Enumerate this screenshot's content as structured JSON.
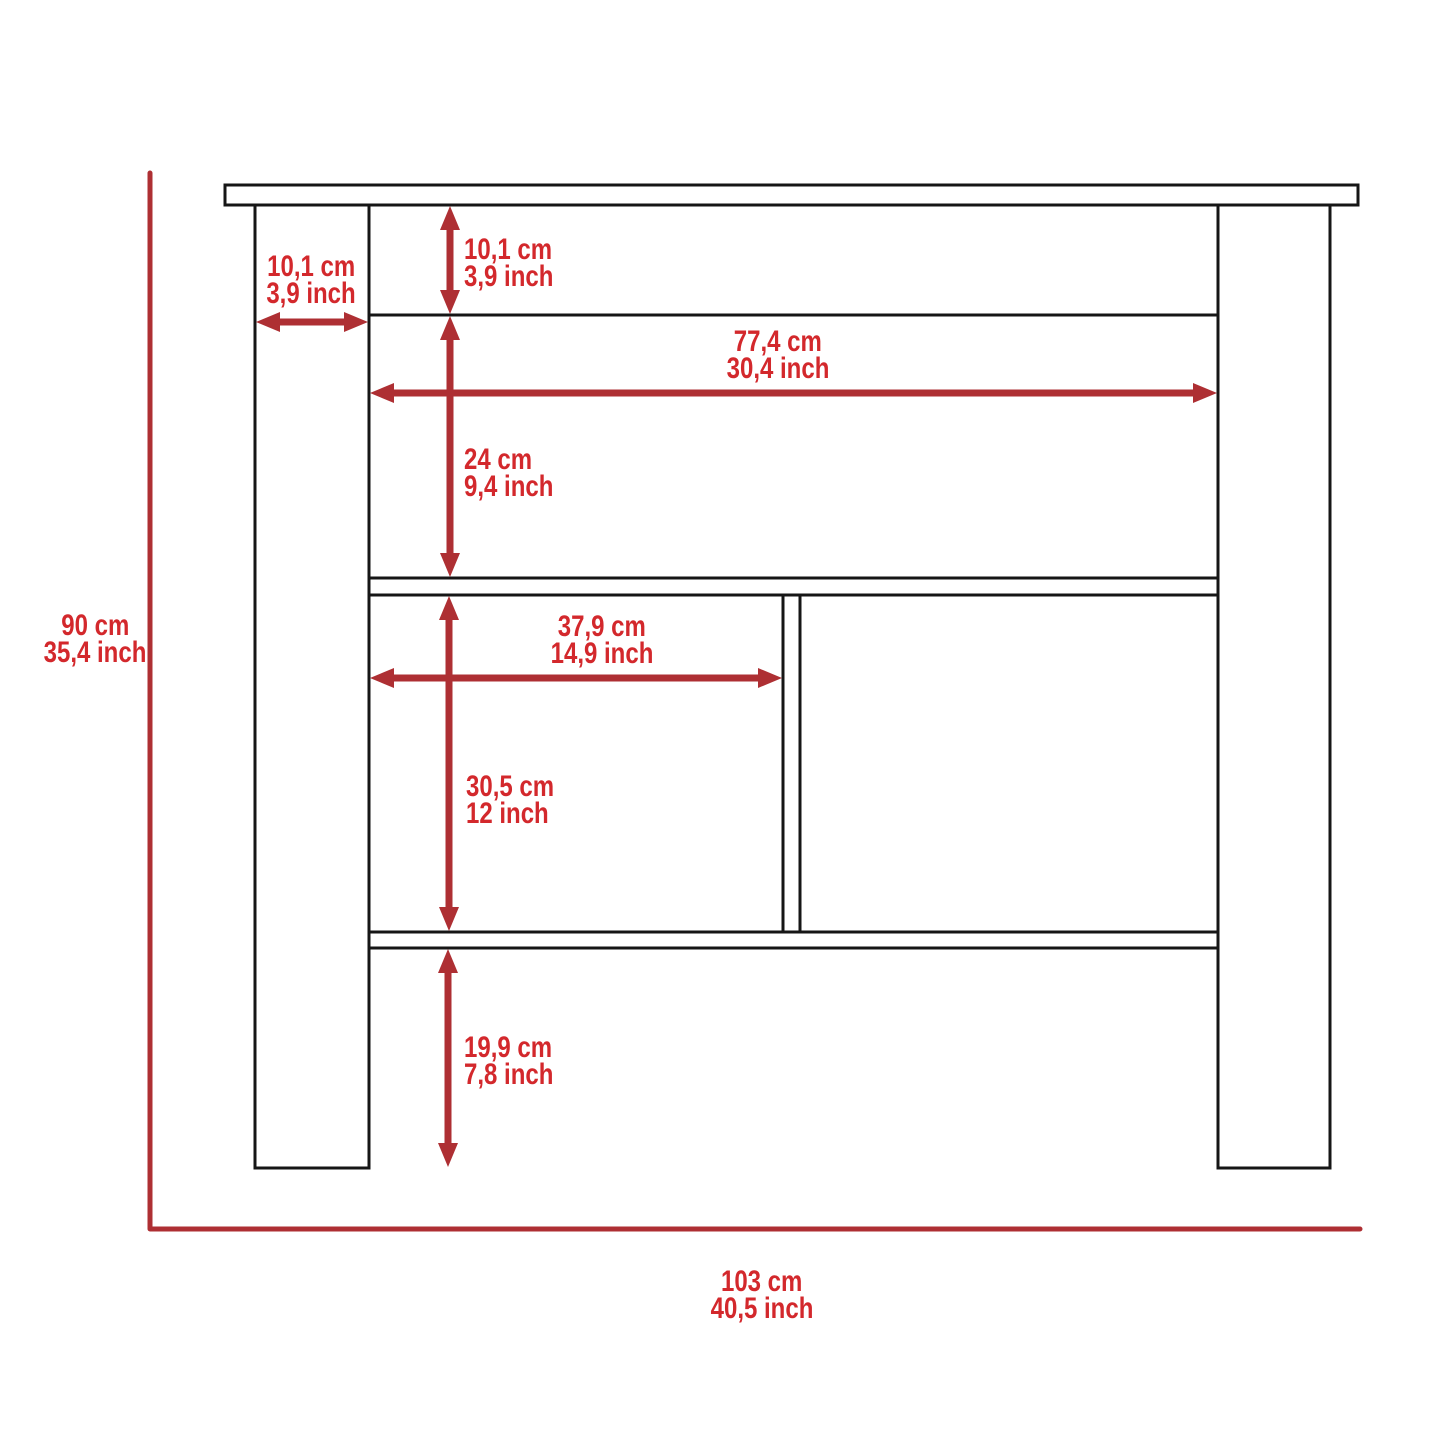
{
  "diagram": {
    "description": "kitchen-island front-view dimension drawing",
    "canvas": {
      "width": 1445,
      "height": 1445
    },
    "colors": {
      "background": "#ffffff",
      "label_red": "#d3282c",
      "line_red": "#ae2f33",
      "outline_black": "#161616"
    },
    "furniture": {
      "top_board": {
        "x": 225,
        "y": 185,
        "w": 1133,
        "h": 20
      },
      "left_leg": {
        "x": 255,
        "y": 205,
        "w": 114,
        "h": 963
      },
      "right_leg": {
        "x": 1218,
        "y": 205,
        "w": 112,
        "h": 963
      },
      "apron_bottom_line": {
        "x1": 369,
        "x2": 1218,
        "y": 315
      },
      "middle_shelf": {
        "x": 369,
        "y": 578,
        "w": 849,
        "h": 17
      },
      "bottom_shelf": {
        "x": 369,
        "y": 932,
        "w": 849,
        "h": 16
      },
      "divider": {
        "x": 783,
        "y": 595,
        "w": 17,
        "h": 337
      }
    },
    "reference_corner": {
      "x": 150,
      "top": 173,
      "bottom": 1229,
      "right": 1360,
      "stroke": 5
    },
    "arrow_style": {
      "shaft": 7,
      "head_len": 24,
      "head_half_w": 10
    },
    "dimensions": {
      "rail_height": {
        "cm": "10,1 cm",
        "inch": "3,9 inch",
        "axis": "v",
        "at": 450,
        "from": 206,
        "to": 314
      },
      "leg_width": {
        "cm": "10,1 cm",
        "inch": "3,9 inch",
        "axis": "h",
        "at": 322,
        "from": 256,
        "to": 368
      },
      "inner_width": {
        "cm": "77,4 cm",
        "inch": "30,4 inch",
        "axis": "h",
        "at": 393,
        "from": 370,
        "to": 1217
      },
      "upper_height": {
        "cm": "24 cm",
        "inch": "9,4 inch",
        "axis": "v",
        "at": 450,
        "from": 316,
        "to": 577
      },
      "left_comp_width": {
        "cm": "37,9 cm",
        "inch": "14,9 inch",
        "axis": "h",
        "at": 678,
        "from": 370,
        "to": 782
      },
      "comp_height": {
        "cm": "30,5 cm",
        "inch": "12 inch",
        "axis": "v",
        "at": 449,
        "from": 596,
        "to": 931
      },
      "lower_height": {
        "cm": "19,9 cm",
        "inch": "7,8 inch",
        "axis": "v",
        "at": 448,
        "from": 949,
        "to": 1167
      },
      "overall_height": {
        "cm": "90 cm",
        "inch": "35,4 inch"
      },
      "overall_width": {
        "cm": "103 cm",
        "inch": "40,5 inch"
      }
    }
  }
}
